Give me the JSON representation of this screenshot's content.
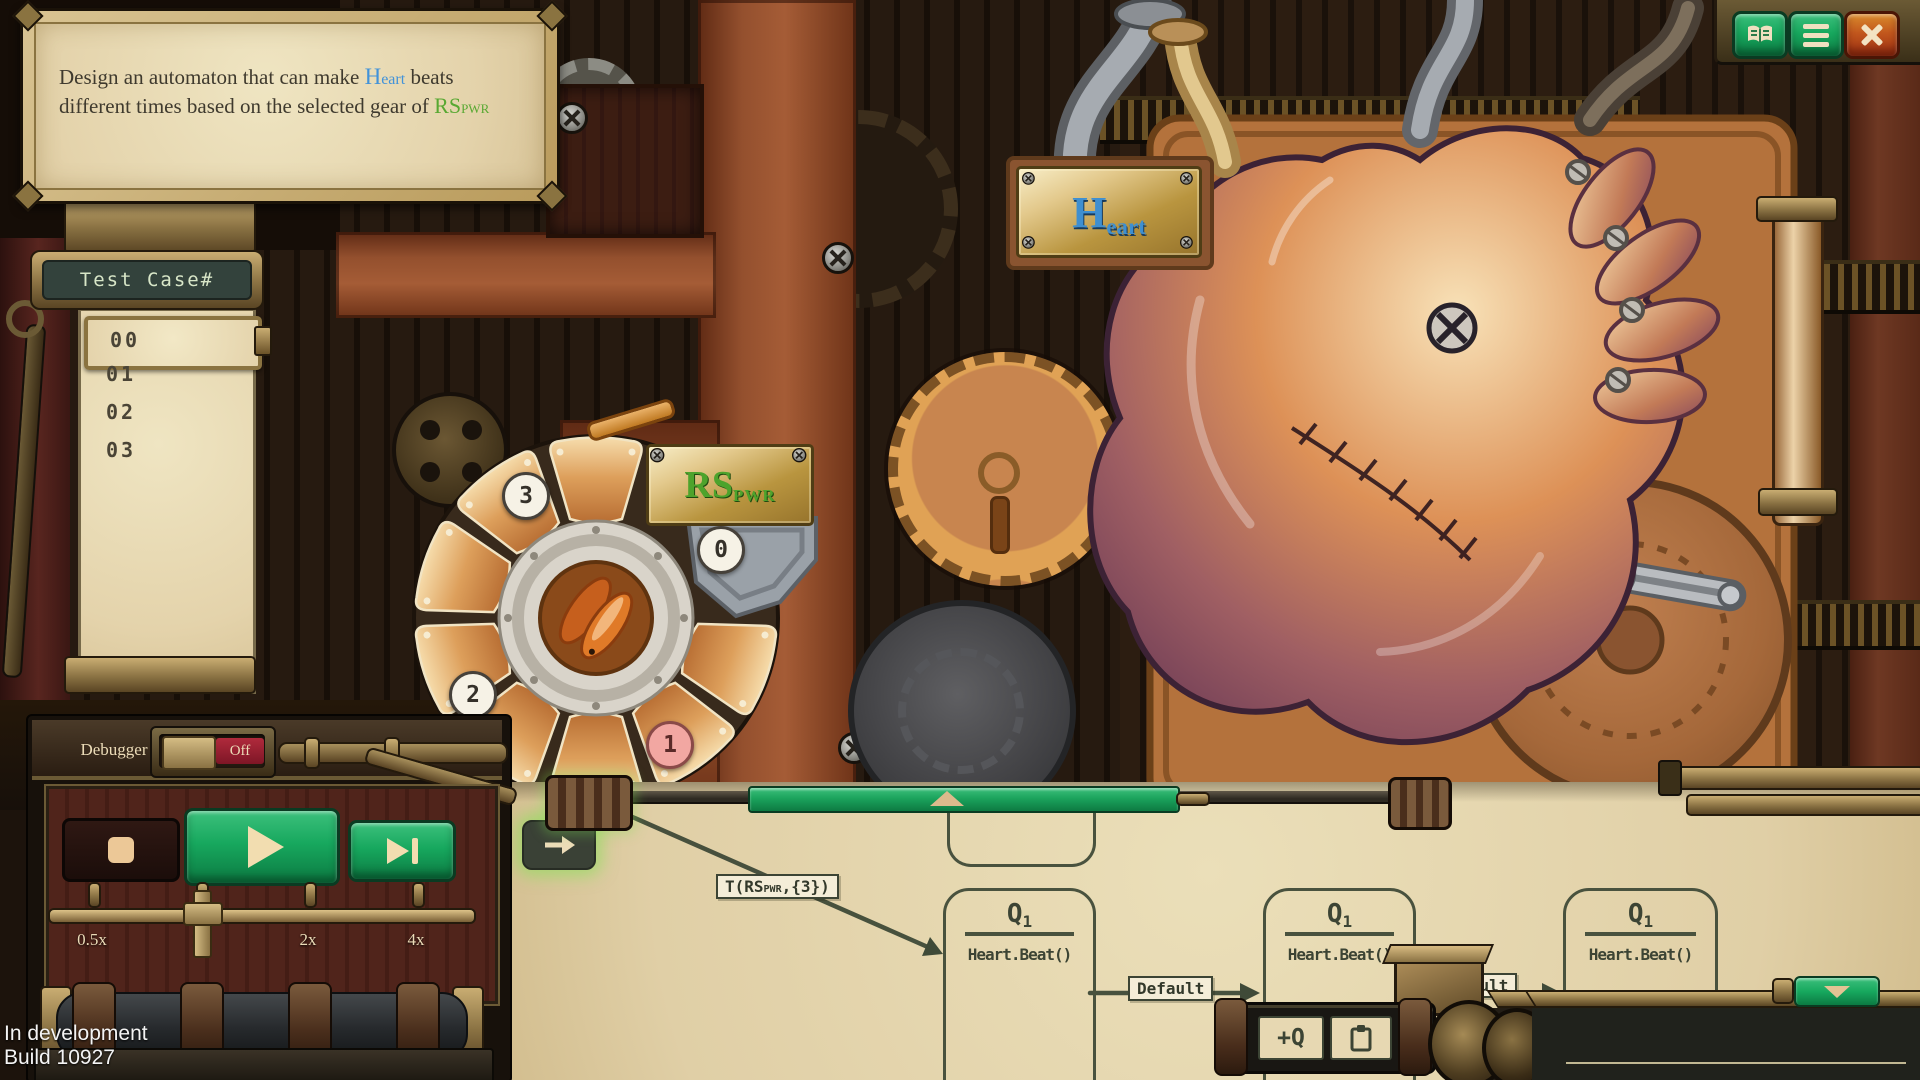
{
  "instruction": {
    "part1": "Design an automaton that can make ",
    "heart_big": "H",
    "heart_small": "eart",
    "part2": " beats different times based on the selected gear of ",
    "rs_big": "RS",
    "rs_small": "PWR"
  },
  "topbar": {
    "manual_icon": "open-book",
    "menu_icon": "menu-lines",
    "close_icon": "x"
  },
  "test_cases": {
    "title": "Test Case#",
    "items": [
      "00",
      "01",
      "02",
      "03"
    ],
    "selected": "00"
  },
  "dial": {
    "plate_big": "RS",
    "plate_small": "PWR",
    "positions": [
      "0",
      "1",
      "2",
      "3"
    ],
    "selected_position": "1"
  },
  "heart": {
    "plate_big": "H",
    "plate_small": "eart"
  },
  "debugger_panel": {
    "label": "Debugger",
    "state": "Off"
  },
  "speed": {
    "labels": [
      "0.5x",
      "1x",
      "2x",
      "4x"
    ],
    "current": "1x"
  },
  "editor": {
    "start_transition": {
      "prefix": "T(RS",
      "sub": "PWR",
      "suffix": ",{3})"
    },
    "states": [
      {
        "name": "Q",
        "sub": "1",
        "action": "Heart.Beat()"
      },
      {
        "name": "Q",
        "sub": "1",
        "action": "Heart.Beat()"
      },
      {
        "name": "Q",
        "sub": "1",
        "action": "Heart.Beat()"
      }
    ],
    "transitions": [
      {
        "label": "Default"
      },
      {
        "label": "Default"
      }
    ],
    "toolbar": {
      "add_state": "+Q",
      "paste_icon": "clipboard"
    }
  },
  "status": {
    "line1": "In development",
    "line2": "Build 10927"
  },
  "colors": {
    "accent_green": "#17a85e",
    "parchment": "#e4d3ab",
    "ink": "#49523e",
    "wood": "#94502e",
    "brass": "#b9953f",
    "alert_red": "#9e1a2f",
    "heart_blue": "#4192d9",
    "rs_green": "#58a832"
  }
}
